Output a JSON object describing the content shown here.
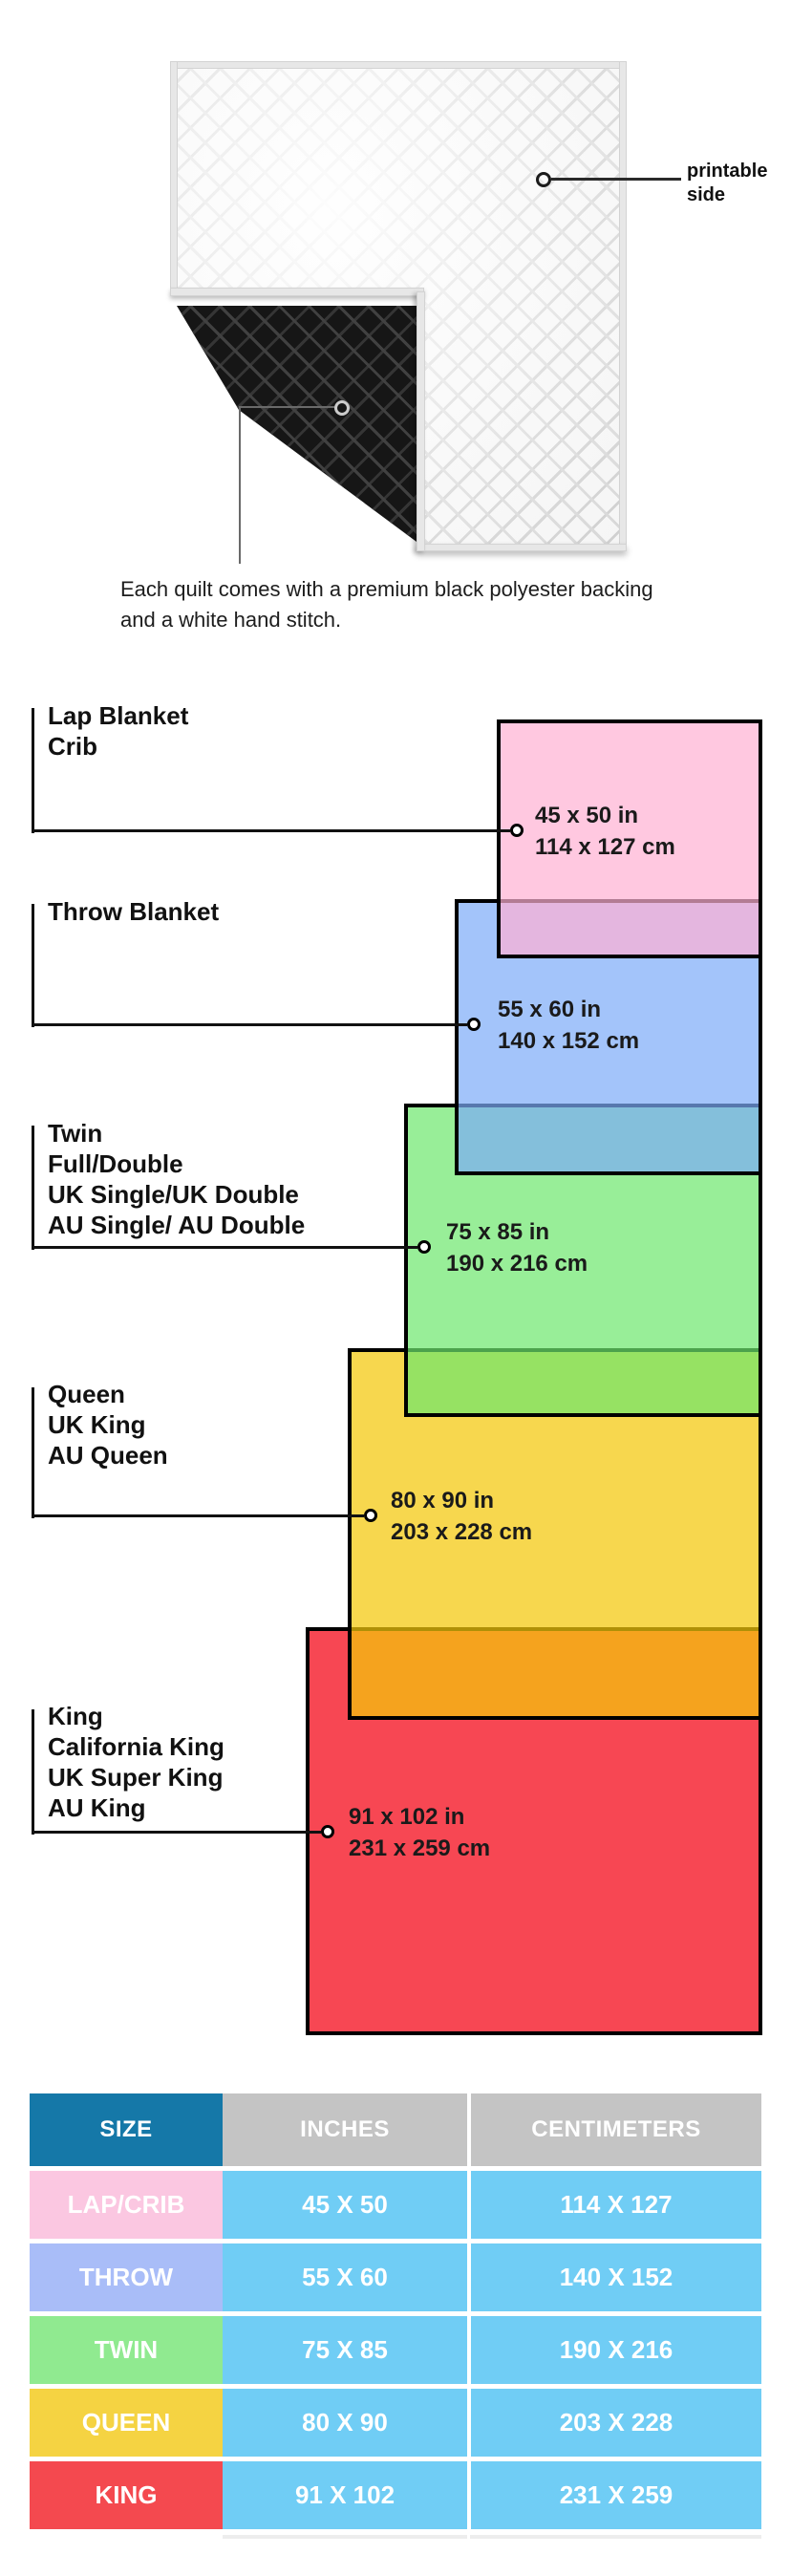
{
  "photo": {
    "printable_callout": "printable side",
    "caption": "Each quilt comes with a premium black polyester backing and a white hand stitch."
  },
  "diagram": {
    "blankets": [
      {
        "id": "lap",
        "labels": [
          "Lap Blanket",
          "Crib"
        ],
        "inches": "45 x 50 in",
        "cm": "114 x 127 cm",
        "fill": "#ffc8e0"
      },
      {
        "id": "throw",
        "labels": [
          "Throw Blanket"
        ],
        "inches": "55 x 60 in",
        "cm": "140 x 152 cm",
        "fill": "#a3c4fa"
      },
      {
        "id": "twin",
        "labels": [
          "Twin",
          "Full/Double",
          "UK Single/UK Double",
          "AU Single/ AU Double"
        ],
        "inches": "75 x 85 in",
        "cm": "190 x 216 cm",
        "fill": "#98ee98"
      },
      {
        "id": "queen",
        "labels": [
          "Queen",
          "UK King",
          "AU Queen"
        ],
        "inches": "80 x 90 in",
        "cm": "203 x 228 cm",
        "fill": "#f7d84f"
      },
      {
        "id": "king",
        "labels": [
          "King",
          "California King",
          "UK Super King",
          "AU King"
        ],
        "inches": "91 x 102 in",
        "cm": "231 x 259 cm",
        "fill": "#f74850"
      }
    ]
  },
  "table": {
    "headers": {
      "size": "SIZE",
      "inches": "INCHES",
      "cm": "CENTIMETERS"
    },
    "header_colors": {
      "size": "#1578a8",
      "measure": "#c4c4c4"
    },
    "data_cell_color": "#70cdf5",
    "rows": [
      {
        "size": "LAP/CRIB",
        "inches": "45 X 50",
        "cm": "114 X 127",
        "color": "#fbc7e1"
      },
      {
        "size": "THROW",
        "inches": "55 X 60",
        "cm": "140 X 152",
        "color": "#a9bdf8"
      },
      {
        "size": "TWIN",
        "inches": "75 X 85",
        "cm": "190 X 216",
        "color": "#90ea90"
      },
      {
        "size": "QUEEN",
        "inches": "80 X 90",
        "cm": "203 X 228",
        "color": "#f5d342"
      },
      {
        "size": "KING",
        "inches": "91 X 102",
        "cm": "231 X 259",
        "color": "#f4494f"
      }
    ]
  }
}
